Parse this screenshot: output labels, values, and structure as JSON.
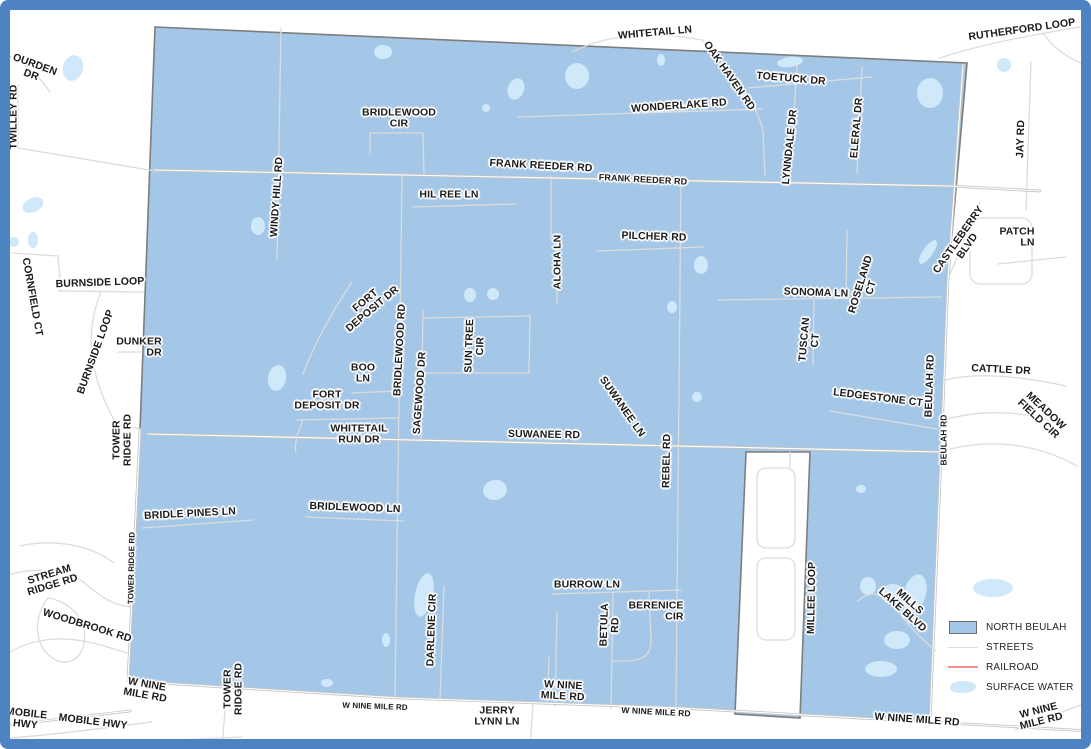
{
  "map": {
    "region_name": "NORTH BEULAH",
    "labels": [
      {
        "id": "ourden-dr",
        "lines": [
          "OURDEN",
          "DR"
        ],
        "x": 33,
        "y": 70,
        "rot": 20
      },
      {
        "id": "twilley-rd",
        "lines": [
          "TWILLEY RD"
        ],
        "x": 14,
        "y": 117,
        "rot": -90
      },
      {
        "id": "whitetail-ln",
        "lines": [
          "WHITETAIL LN"
        ],
        "x": 655,
        "y": 33,
        "rot": -5
      },
      {
        "id": "rutherford-loop",
        "lines": [
          "RUTHERFORD LOOP"
        ],
        "x": 1022,
        "y": 30,
        "rot": -8
      },
      {
        "id": "oak-haven-rd",
        "lines": [
          "OAK HAVEN RD"
        ],
        "x": 729,
        "y": 76,
        "rot": 55
      },
      {
        "id": "toetuck-dr",
        "lines": [
          "TOETUCK DR"
        ],
        "x": 791,
        "y": 79,
        "rot": 5
      },
      {
        "id": "wonderlake-rd",
        "lines": [
          "WONDERLAKE RD"
        ],
        "x": 679,
        "y": 106,
        "rot": -4
      },
      {
        "id": "bridlewood-cir",
        "lines": [
          "BRIDLEWOOD",
          "CIR"
        ],
        "x": 399,
        "y": 118,
        "rot": 0
      },
      {
        "id": "lynndale-dr",
        "lines": [
          "LYNNDALE DR"
        ],
        "x": 790,
        "y": 147,
        "rot": -84
      },
      {
        "id": "eleral-dr",
        "lines": [
          "ELERAL DR"
        ],
        "x": 857,
        "y": 128,
        "rot": -85
      },
      {
        "id": "jay-rd",
        "lines": [
          "JAY RD"
        ],
        "x": 1021,
        "y": 139,
        "rot": -88
      },
      {
        "id": "frank-reeder-rd-w",
        "lines": [
          "FRANK REEDER RD"
        ],
        "x": 541,
        "y": 166,
        "rot": 3
      },
      {
        "id": "frank-reeder-rd-e",
        "lines": [
          "FRANK REEDER RD"
        ],
        "x": 643,
        "y": 180,
        "rot": 3,
        "size": 9
      },
      {
        "id": "hil-ree-ln",
        "lines": [
          "HIL REE LN"
        ],
        "x": 449,
        "y": 195,
        "rot": 0
      },
      {
        "id": "windy-hill-rd",
        "lines": [
          "WINDY HILL RD"
        ],
        "x": 277,
        "y": 197,
        "rot": -86
      },
      {
        "id": "pilcher-rd",
        "lines": [
          "PILCHER RD"
        ],
        "x": 654,
        "y": 237,
        "rot": 2
      },
      {
        "id": "aloha-ln",
        "lines": [
          "ALOHA LN"
        ],
        "x": 558,
        "y": 262,
        "rot": -90
      },
      {
        "id": "castleberry-blvd",
        "lines": [
          "CASTLEBERRY",
          "BLVD"
        ],
        "x": 963,
        "y": 243,
        "rot": -55
      },
      {
        "id": "patch-ln",
        "lines": [
          "PATCH",
          "LN"
        ],
        "x": 1017,
        "y": 237,
        "rot": 0,
        "align": "right"
      },
      {
        "id": "cornfield-ct",
        "lines": [
          "CORNFIELD CT"
        ],
        "x": 32,
        "y": 297,
        "rot": 80
      },
      {
        "id": "burnside-loop",
        "lines": [
          "BURNSIDE LOOP"
        ],
        "x": 100,
        "y": 283,
        "rot": -2
      },
      {
        "id": "sonoma-ln",
        "lines": [
          "SONOMA LN"
        ],
        "x": 816,
        "y": 293,
        "rot": 2
      },
      {
        "id": "roseland-ct",
        "lines": [
          "ROSELAND",
          "CT"
        ],
        "x": 866,
        "y": 286,
        "rot": -73
      },
      {
        "id": "burnside-loop-diag",
        "lines": [
          "BURNSIDE LOOP"
        ],
        "x": 96,
        "y": 352,
        "rot": -70
      },
      {
        "id": "dunker-dr",
        "lines": [
          "DUNKER",
          "DR"
        ],
        "x": 139,
        "y": 347,
        "rot": 0,
        "align": "right"
      },
      {
        "id": "tuscan-ct",
        "lines": [
          "TUSCAN",
          "CT"
        ],
        "x": 810,
        "y": 340,
        "rot": -85
      },
      {
        "id": "fort-deposit-dr-upper",
        "lines": [
          "FORT",
          "DEPOSIT DR"
        ],
        "x": 369,
        "y": 305,
        "rot": -40
      },
      {
        "id": "bridlewood-rd",
        "lines": [
          "BRIDLEWOOD RD"
        ],
        "x": 400,
        "y": 350,
        "rot": -87
      },
      {
        "id": "sagewood-dr",
        "lines": [
          "SAGEWOOD DR"
        ],
        "x": 420,
        "y": 393,
        "rot": -86
      },
      {
        "id": "sun-tree-cir",
        "lines": [
          "SUN TREE",
          "CIR"
        ],
        "x": 475,
        "y": 346,
        "rot": -88
      },
      {
        "id": "boo-ln",
        "lines": [
          "BOO",
          "LN"
        ],
        "x": 363,
        "y": 373,
        "rot": 0
      },
      {
        "id": "fort-deposit-dr-lower",
        "lines": [
          "FORT",
          "DEPOSIT DR"
        ],
        "x": 327,
        "y": 400,
        "rot": 0
      },
      {
        "id": "whitetail-run-dr",
        "lines": [
          "WHITETAIL",
          "RUN DR"
        ],
        "x": 359,
        "y": 434,
        "rot": 0
      },
      {
        "id": "tower-ridge-rd-mid",
        "lines": [
          "TOWER",
          "RIDGE RD"
        ],
        "x": 122,
        "y": 440,
        "rot": -90
      },
      {
        "id": "suwanee-rd",
        "lines": [
          "SUWANEE RD"
        ],
        "x": 544,
        "y": 435,
        "rot": 1
      },
      {
        "id": "suwanee-ln",
        "lines": [
          "SUWANEE LN"
        ],
        "x": 622,
        "y": 407,
        "rot": 55
      },
      {
        "id": "rebel-rd",
        "lines": [
          "REBEL RD"
        ],
        "x": 667,
        "y": 461,
        "rot": -89
      },
      {
        "id": "ledgestone-ct",
        "lines": [
          "LEDGESTONE CT"
        ],
        "x": 878,
        "y": 398,
        "rot": 7
      },
      {
        "id": "beulah-rd",
        "lines": [
          "BEULAH RD"
        ],
        "x": 930,
        "y": 386,
        "rot": -88
      },
      {
        "id": "beulah-rd-small",
        "lines": [
          "BEULAH RD"
        ],
        "x": 944,
        "y": 440,
        "rot": -90,
        "size": 8.5
      },
      {
        "id": "cattle-dr",
        "lines": [
          "CATTLE DR"
        ],
        "x": 1001,
        "y": 370,
        "rot": 3
      },
      {
        "id": "meadow-field-cir",
        "lines": [
          "MEADOW",
          "FIELD CIR"
        ],
        "x": 1042,
        "y": 415,
        "rot": 43
      },
      {
        "id": "bridle-pines-ln",
        "lines": [
          "BRIDLE PINES LN"
        ],
        "x": 190,
        "y": 514,
        "rot": -3
      },
      {
        "id": "bridlewood-ln",
        "lines": [
          "BRIDLEWOOD LN"
        ],
        "x": 355,
        "y": 508,
        "rot": 2
      },
      {
        "id": "tower-ridge-rd-small",
        "lines": [
          "TOWER RIDGE RD"
        ],
        "x": 132,
        "y": 568,
        "rot": -89,
        "size": 8
      },
      {
        "id": "stream-ridge-rd",
        "lines": [
          "STREAM",
          "RIDGE RD"
        ],
        "x": 51,
        "y": 580,
        "rot": -17
      },
      {
        "id": "woodbrook-rd",
        "lines": [
          "WOODBROOK RD"
        ],
        "x": 87,
        "y": 626,
        "rot": 17
      },
      {
        "id": "darlene-cir",
        "lines": [
          "DARLENE CIR"
        ],
        "x": 432,
        "y": 630,
        "rot": -88
      },
      {
        "id": "burrow-ln",
        "lines": [
          "BURROW LN"
        ],
        "x": 587,
        "y": 585,
        "rot": 0
      },
      {
        "id": "berenice-cir",
        "lines": [
          "BERENICE",
          "CIR"
        ],
        "x": 656,
        "y": 611,
        "rot": 0,
        "align": "right"
      },
      {
        "id": "betula-rd",
        "lines": [
          "BETULA",
          "RD"
        ],
        "x": 610,
        "y": 625,
        "rot": -88
      },
      {
        "id": "millee-loop",
        "lines": [
          "MILLEE LOOP"
        ],
        "x": 812,
        "y": 598,
        "rot": -89
      },
      {
        "id": "mills-lake-blvd",
        "lines": [
          "MILLS",
          "LAKE BLVD"
        ],
        "x": 906,
        "y": 606,
        "rot": 42
      },
      {
        "id": "tower-ridge-rd-bottom",
        "lines": [
          "TOWER",
          "RIDGE RD"
        ],
        "x": 233,
        "y": 689,
        "rot": -90
      },
      {
        "id": "w-nine-mile-rd-left",
        "lines": [
          "W NINE",
          "MILE RD"
        ],
        "x": 146,
        "y": 690,
        "rot": 10
      },
      {
        "id": "mobile-hwy-left",
        "lines": [
          "MOBILE",
          "HWY"
        ],
        "x": 26,
        "y": 719,
        "rot": 6
      },
      {
        "id": "mobile-hwy",
        "lines": [
          "MOBILE HWY"
        ],
        "x": 93,
        "y": 722,
        "rot": 7
      },
      {
        "id": "w-nine-mile-rd-sm1",
        "lines": [
          "W NINE MILE RD"
        ],
        "x": 375,
        "y": 707,
        "rot": 2,
        "size": 8
      },
      {
        "id": "jerry-lynn-ln",
        "lines": [
          "JERRY",
          "LYNN LN"
        ],
        "x": 497,
        "y": 716,
        "rot": 0
      },
      {
        "id": "w-nine-mile-rd-mid",
        "lines": [
          "W NINE",
          "MILE RD"
        ],
        "x": 563,
        "y": 691,
        "rot": 3
      },
      {
        "id": "w-nine-mile-rd-sm2",
        "lines": [
          "W NINE MILE RD"
        ],
        "x": 656,
        "y": 712,
        "rot": 3,
        "size": 8.5
      },
      {
        "id": "w-nine-mile-rd-e",
        "lines": [
          "W NINE MILE RD"
        ],
        "x": 917,
        "y": 720,
        "rot": 4
      },
      {
        "id": "w-nine-mile-rd-corner",
        "lines": [
          "W NINE",
          "MILE RD"
        ],
        "x": 1040,
        "y": 716,
        "rot": -14
      }
    ]
  },
  "legend": {
    "items": [
      {
        "id": "north-beulah",
        "label": "NORTH BEULAH",
        "marker": "region"
      },
      {
        "id": "streets",
        "label": "STREETS",
        "marker": "street-line"
      },
      {
        "id": "railroad",
        "label": "RAILROAD",
        "marker": "railroad-line"
      },
      {
        "id": "surface-water",
        "label": "SURFACE WATER",
        "marker": "water-blob"
      }
    ]
  },
  "colors": {
    "frame": "#4d82c3",
    "background": "#ffffff",
    "region_fill": "#a4c7e8",
    "region_border": "#7d7d7d",
    "street": "#dcdcdc",
    "road_major": "#c4c4c4",
    "railroad": "#f2918d",
    "water": "#cfe9fa",
    "label_text": "#1b1b1b"
  }
}
